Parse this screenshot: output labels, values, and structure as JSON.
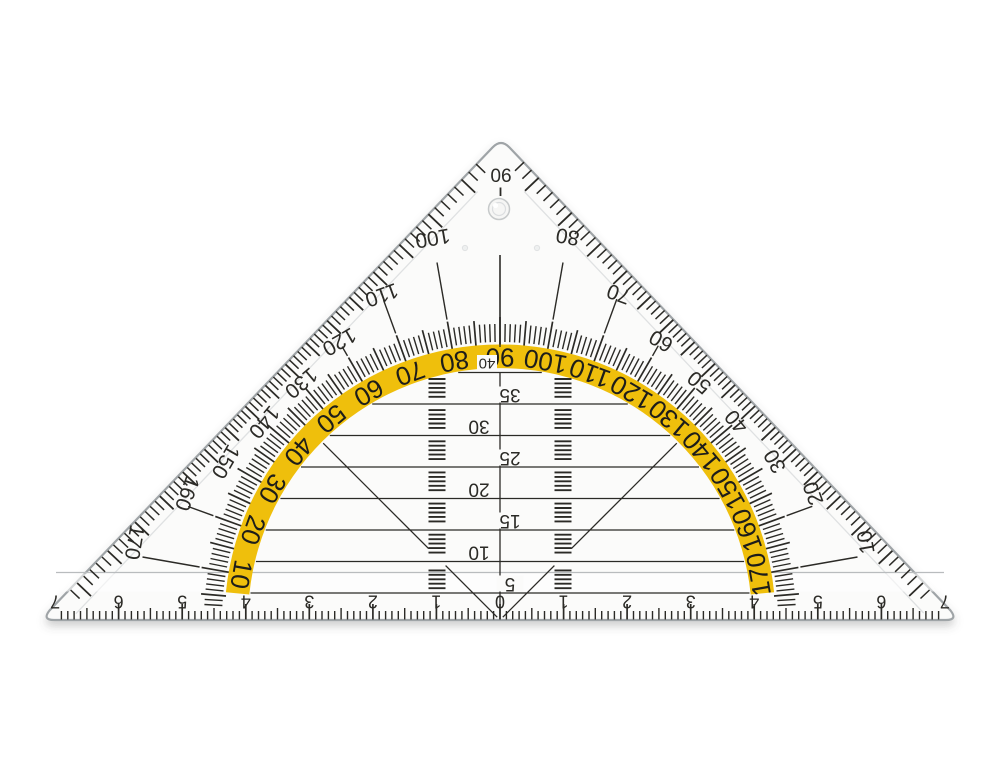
{
  "object_label": "transparent protractor set square",
  "colors": {
    "ink": "#2b2a26",
    "arc_yellow": "#EFBF0C",
    "plastic": "#fbfbfa",
    "plastic_edge": "#9fa4a7",
    "bevel": "#dfe1e2",
    "bevel_strong": "#b9bcbe",
    "hole_ring": "#c6c9ca"
  },
  "protractor": {
    "apex_label": "90",
    "edge_labels_left": [
      "100",
      "110",
      "120",
      "130",
      "140",
      "150",
      "160",
      "170"
    ],
    "edge_labels_right": [
      "80",
      "70",
      "60",
      "50",
      "40",
      "30",
      "20",
      "10"
    ],
    "arc_labels": [
      "10",
      "20",
      "30",
      "40",
      "50",
      "60",
      "70",
      "80",
      "90",
      "100",
      "110",
      "120",
      "130",
      "140",
      "150",
      "160",
      "170"
    ],
    "degree_tick_step": 1,
    "label_step": 10
  },
  "grid": {
    "labels": [
      "5",
      "10",
      "15",
      "20",
      "25",
      "30",
      "35",
      "40"
    ],
    "spacing_mm": 5
  },
  "ruler": {
    "zero": "0",
    "labels": [
      "1",
      "2",
      "3",
      "4",
      "5",
      "6",
      "7"
    ]
  },
  "geometry": {
    "cx": 500,
    "cy": 620,
    "apex": [
      501,
      138
    ],
    "corner_left": [
      42,
      620
    ],
    "corner_right": [
      958,
      620
    ],
    "mm_px": 6.356,
    "grid_y0": 593,
    "grid_dy": 31.5,
    "grid_clip_r": 251,
    "yellow_r_in": 252,
    "yellow_r_out": 275.5,
    "yellow_deg_span": [
      5.8,
      174.2
    ],
    "arc_label_r": 262.5,
    "band_r": {
      "s": [
        278,
        296
      ],
      "m": [
        275,
        300
      ],
      "l": [
        272,
        303
      ]
    },
    "leader_r0": 305,
    "leader_rmax": 363,
    "edge_label_inset": 24,
    "hatch_x": [
      437,
      563
    ],
    "hatch_half": 8.5,
    "hole": [
      499,
      209,
      10.5
    ],
    "dimples": [
      [
        465,
        248
      ],
      [
        537,
        248
      ]
    ]
  }
}
